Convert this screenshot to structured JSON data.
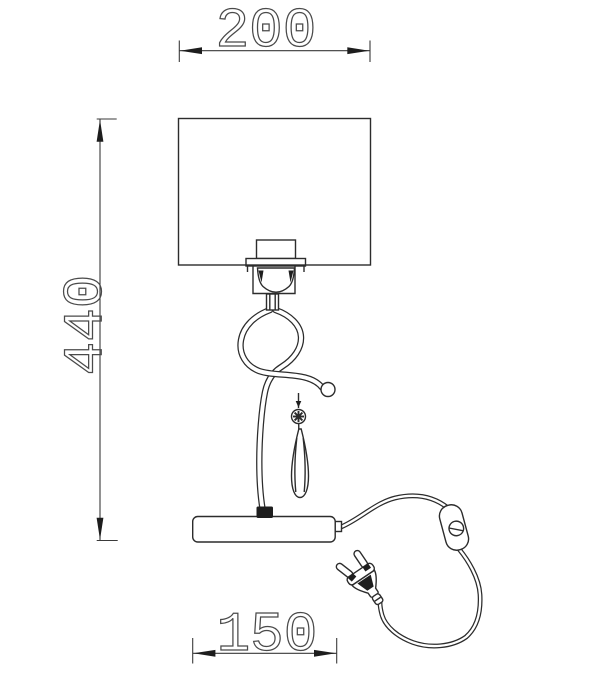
{
  "drawing": {
    "subject": "table-lamp-technical-drawing",
    "background_color": "#ffffff",
    "line_color": "#2c2c2c",
    "dimensions": {
      "top": {
        "label": "200",
        "orientation": "horizontal",
        "position": "top",
        "refers_to": "shade width"
      },
      "left": {
        "label": "440",
        "orientation": "vertical",
        "position": "left",
        "refers_to": "total height"
      },
      "bottom": {
        "label": "150",
        "orientation": "horizontal",
        "position": "bottom",
        "refers_to": "base width"
      }
    },
    "parts": {
      "shade": "rectangular-lamp-shade",
      "socket": "bulb-socket-holder",
      "stem": "scrolled-wire-stem",
      "ball": "ball-finial",
      "flower": "flower-ornament",
      "pendant": "crystal-teardrop-pendant",
      "base": "lamp-base",
      "cord": "power-cord",
      "switch": "inline-switch",
      "plug": "two-pin-europlug"
    }
  }
}
